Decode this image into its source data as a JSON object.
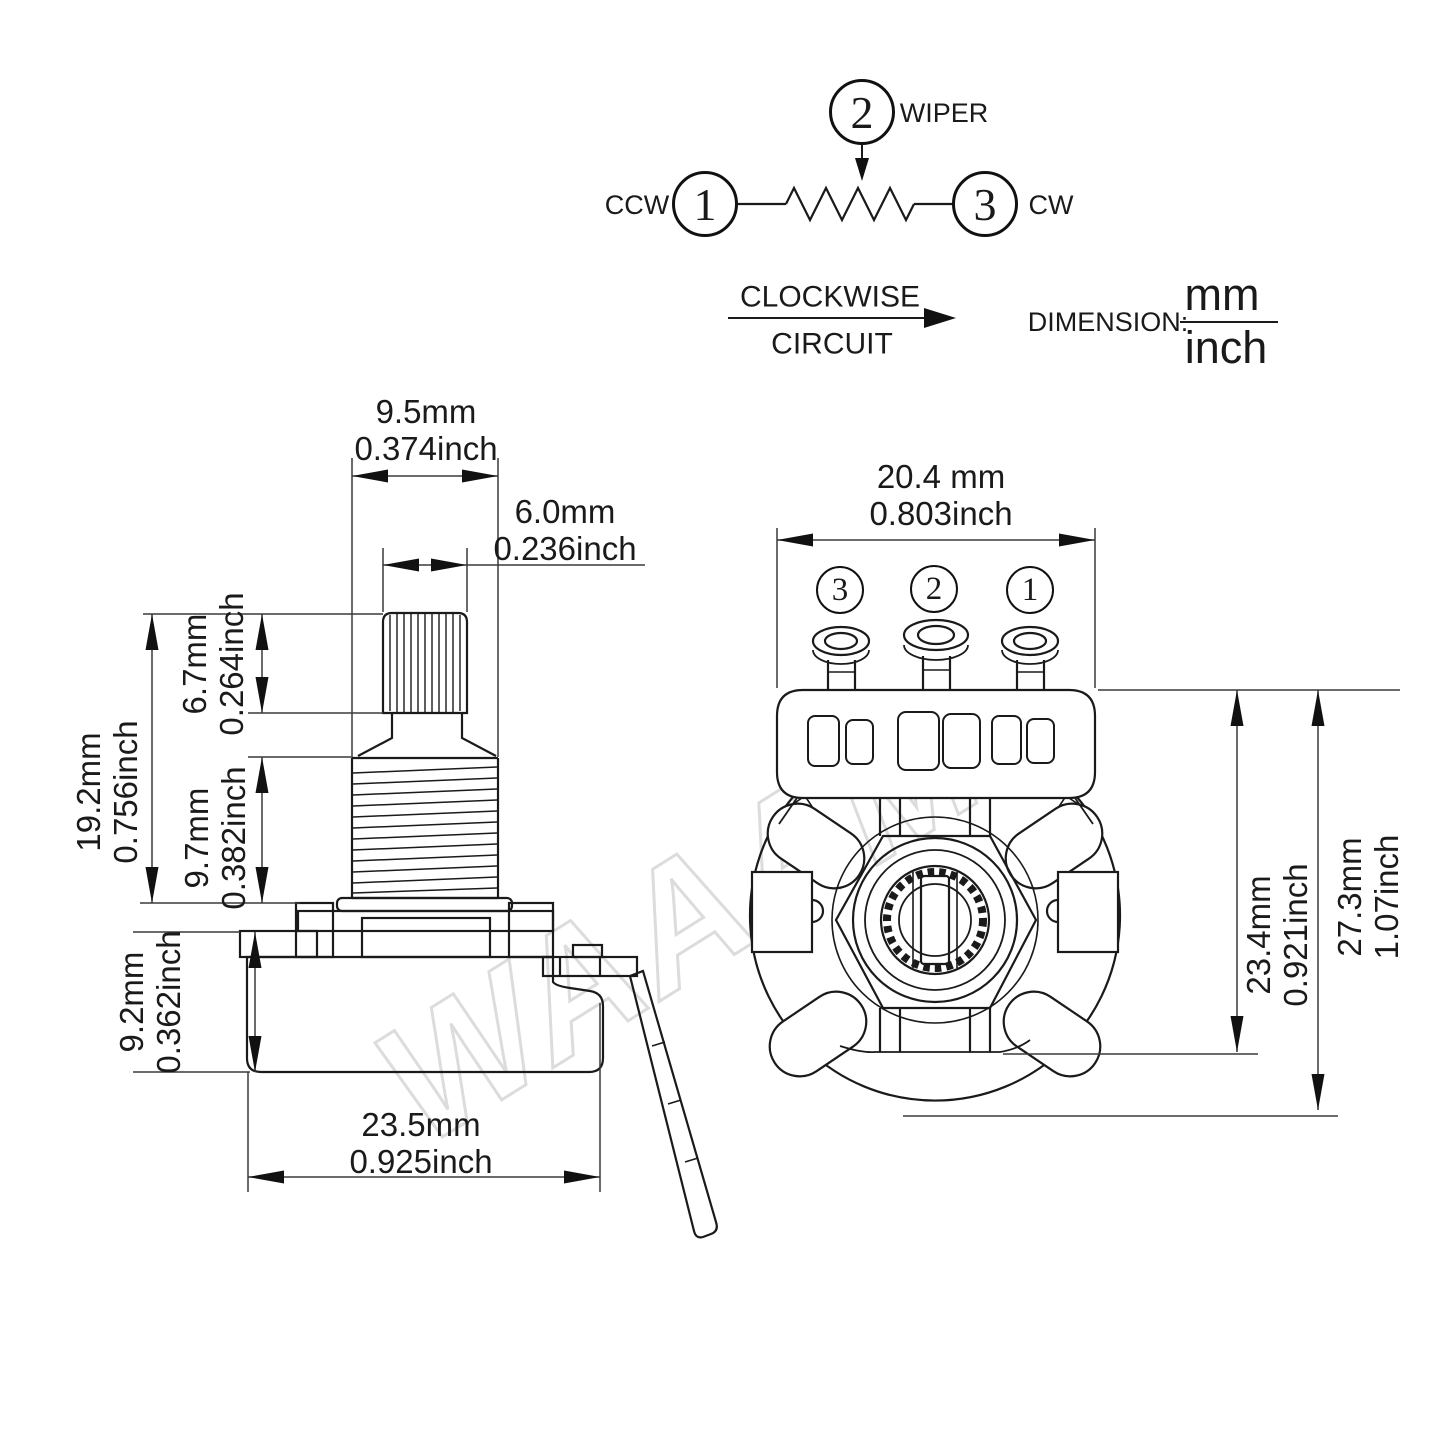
{
  "watermark": "WAAAM",
  "schematic": {
    "wiper": {
      "num": "2",
      "label": "WIPER"
    },
    "ccw": {
      "num": "1",
      "label": "CCW"
    },
    "cw": {
      "num": "3",
      "label": "CW"
    },
    "flow_top": "CLOCKWISE",
    "flow_bottom": "CIRCUIT",
    "dimension_label": "DIMENSION:",
    "dimension_numerator": "mm",
    "dimension_denominator": "inch"
  },
  "side_view": {
    "bushing_diameter": {
      "mm": "9.5mm",
      "inch": "0.374inch"
    },
    "shaft_diameter": {
      "mm": "6.0mm",
      "inch": "0.236inch"
    },
    "shaft_height": {
      "mm": "19.2mm",
      "inch": "0.756inch"
    },
    "knurl_height": {
      "mm": "6.7mm",
      "inch": "0.264inch"
    },
    "bushing_height": {
      "mm": "9.7mm",
      "inch": "0.382inch"
    },
    "body_height": {
      "mm": "9.2mm",
      "inch": "0.362inch"
    },
    "body_diameter": {
      "mm": "23.5mm",
      "inch": "0.925inch"
    }
  },
  "back_view": {
    "terminal_3": "3",
    "terminal_2": "2",
    "terminal_1": "1",
    "terminal_span": {
      "mm": "20.4 mm",
      "inch": "0.803inch"
    },
    "cover_height": {
      "mm": "23.4mm",
      "inch": "0.921inch"
    },
    "total_height": {
      "mm": "27.3mm",
      "inch": "1.07inch"
    }
  }
}
